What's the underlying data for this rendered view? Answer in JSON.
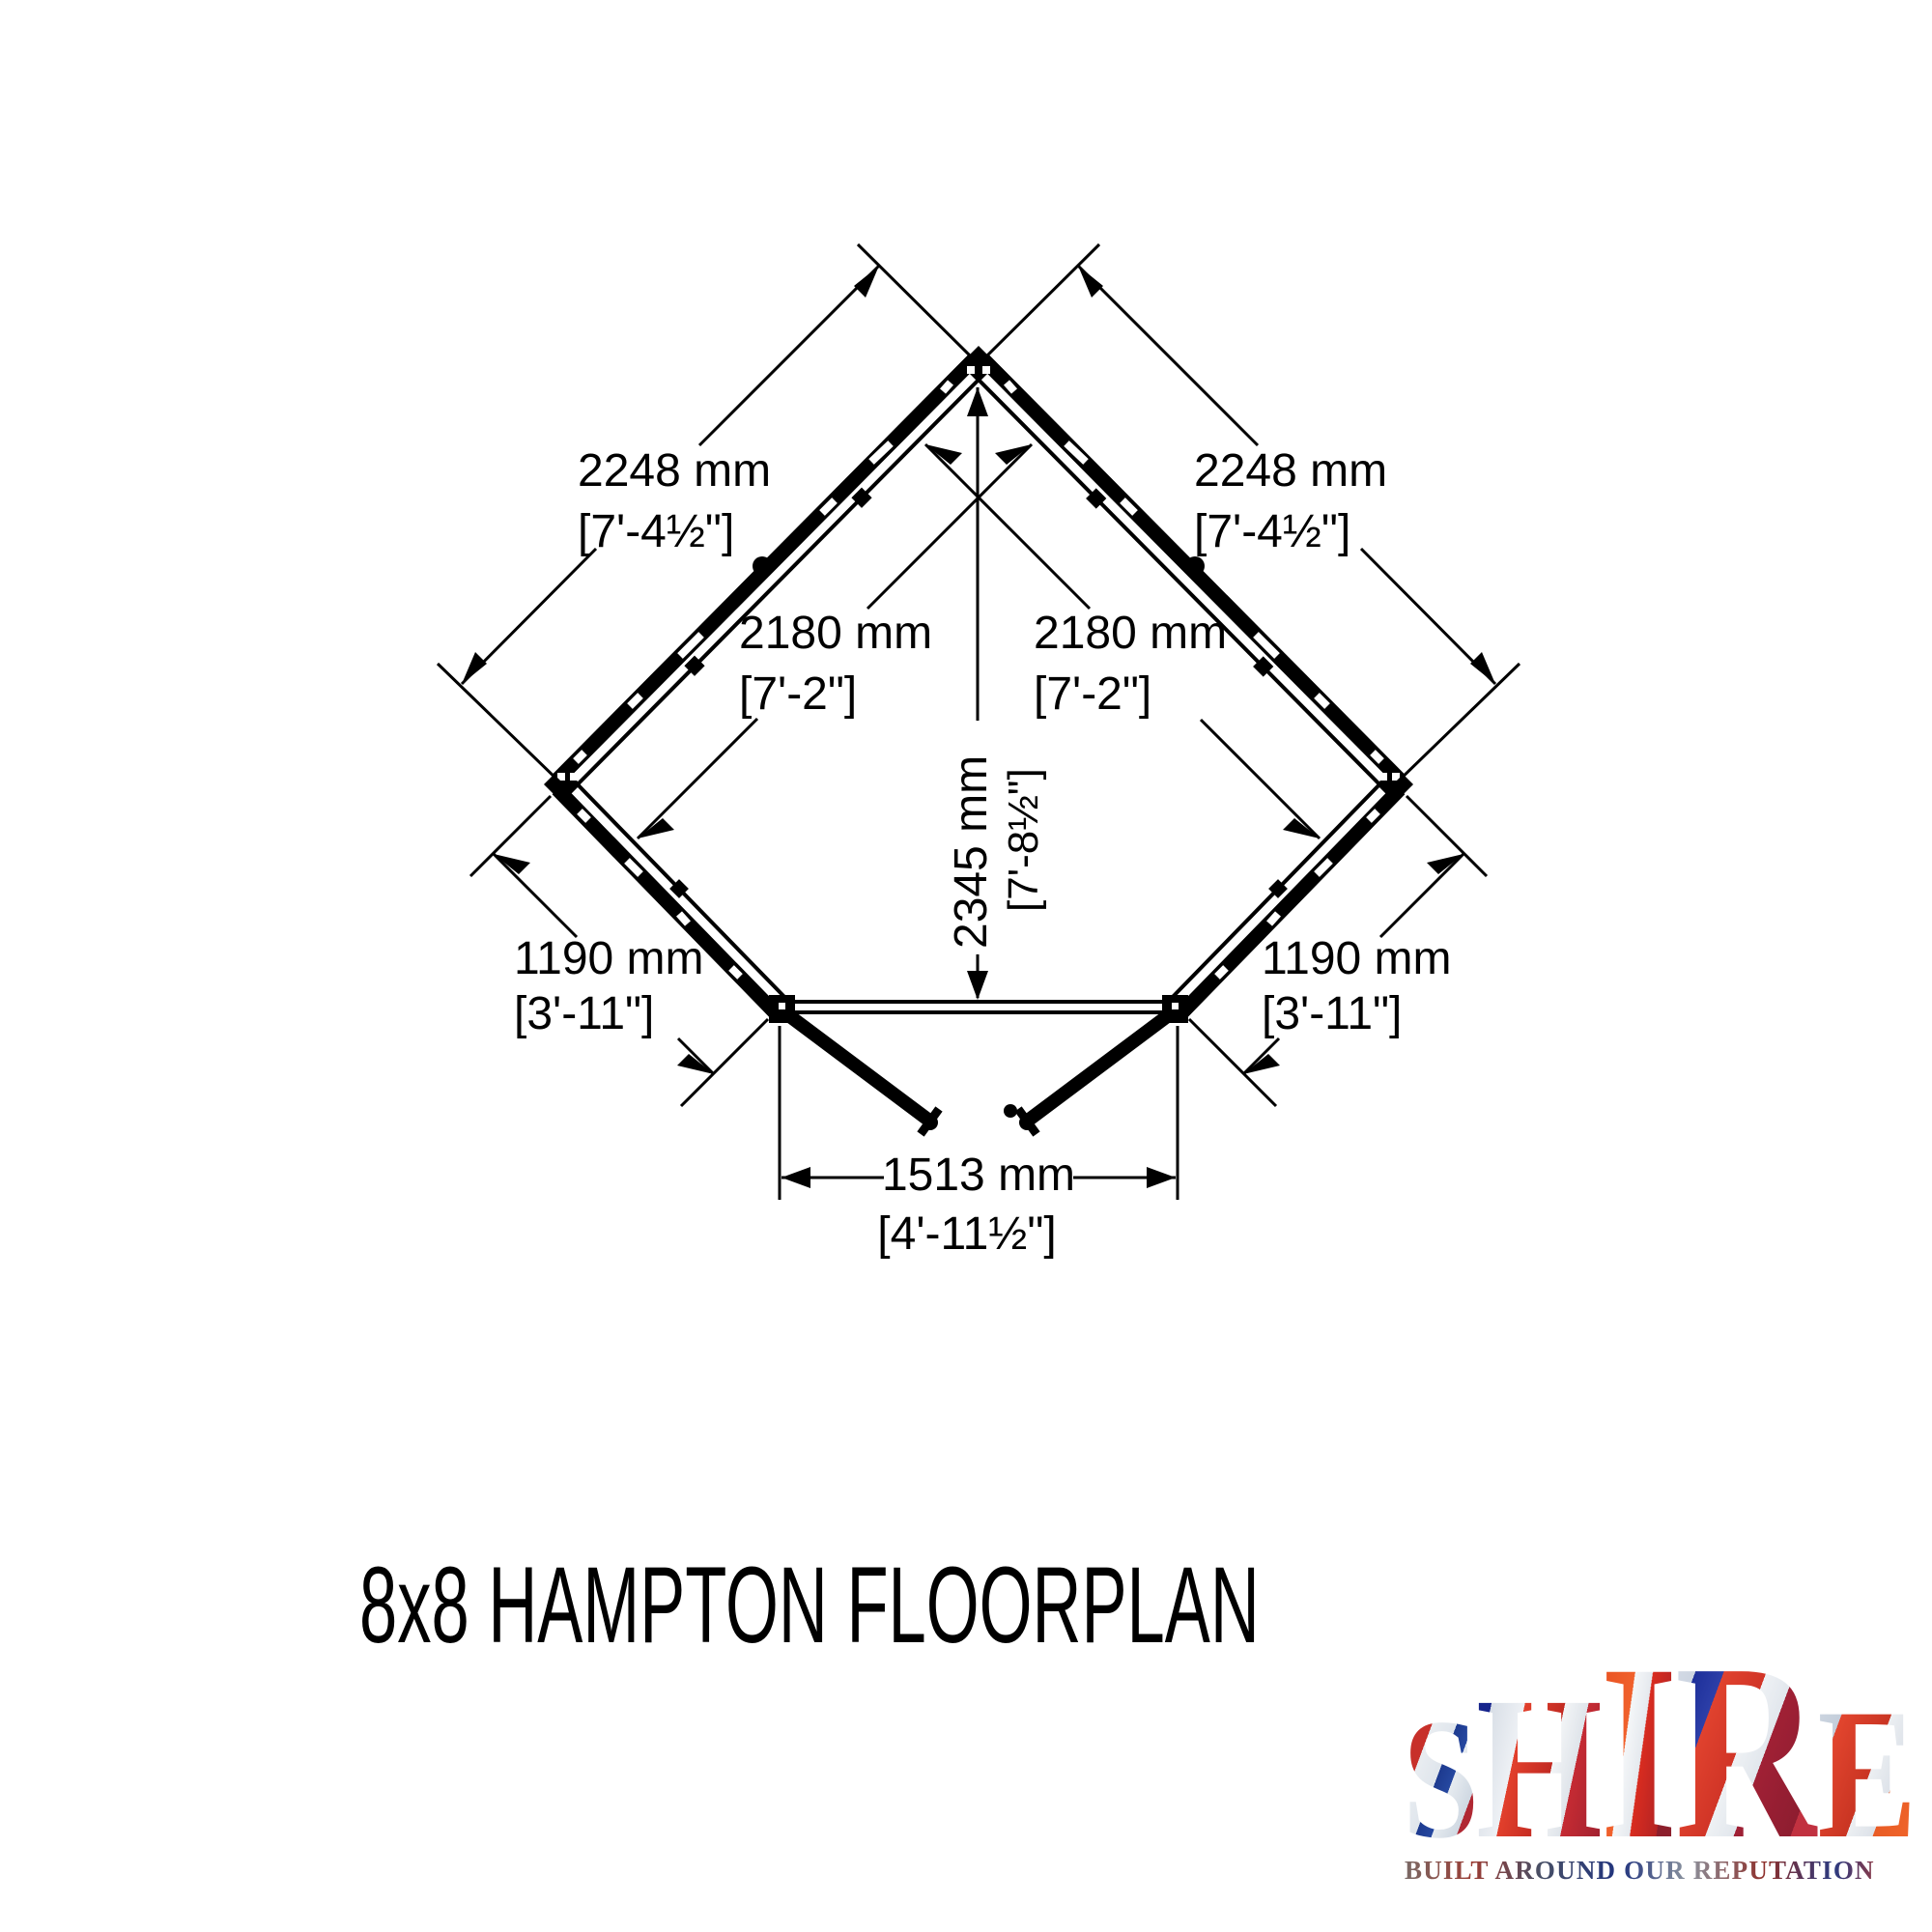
{
  "title": "8x8 HAMPTON FLOORPLAN",
  "floorplan": {
    "dimensions": {
      "side_wall_left": {
        "metric": "2248 mm",
        "imperial": "[7'-4½\"]"
      },
      "side_wall_right": {
        "metric": "2248 mm",
        "imperial": "[7'-4½\"]"
      },
      "internal_left": {
        "metric": "2180 mm",
        "imperial": "[7'-2\"]"
      },
      "internal_right": {
        "metric": "2180 mm",
        "imperial": "[7'-2\"]"
      },
      "depth": {
        "metric": "2345 mm",
        "imperial": "[7'-8½\"]"
      },
      "front_wall_left": {
        "metric": "1190 mm",
        "imperial": "[3'-11\"]"
      },
      "front_wall_right": {
        "metric": "1190 mm",
        "imperial": "[3'-11\"]"
      },
      "door_opening": {
        "metric": "1513 mm",
        "imperial": "[4'-11½\"]"
      }
    }
  },
  "logo": {
    "brand": "SHIRE",
    "letters": [
      "S",
      "H",
      "I",
      "R",
      "E"
    ],
    "tagline": "BUILT AROUND OUR REPUTATION",
    "colors": {
      "red": "#c7302a",
      "blue": "#1d2f9a",
      "silver": "#e9edf1"
    }
  },
  "drawing": {
    "line_color": "#000000",
    "background": "#ffffff"
  }
}
